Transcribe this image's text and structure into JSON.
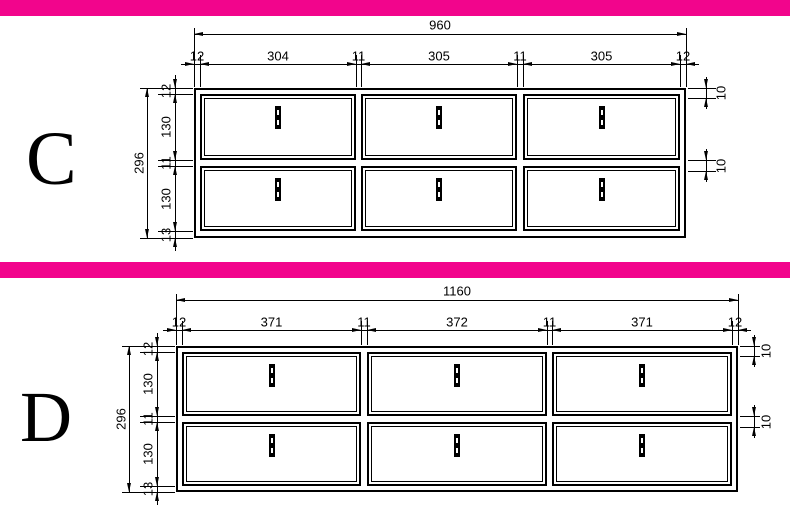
{
  "colors": {
    "separator_pink": "#F2058C",
    "line": "#000000",
    "background": "#FFFFFF"
  },
  "drawings": [
    {
      "label": "C",
      "width_total": "960",
      "width_segments": [
        "12",
        "304",
        "11",
        "305",
        "11",
        "305",
        "12"
      ],
      "height_total": "296",
      "height_segments": [
        "12",
        "130",
        "11",
        "130",
        "13"
      ],
      "side_offsets": [
        "10",
        "10"
      ]
    },
    {
      "label": "D",
      "width_total": "1160",
      "width_segments": [
        "12",
        "371",
        "11",
        "372",
        "11",
        "371",
        "12"
      ],
      "height_total": "296",
      "height_segments": [
        "12",
        "130",
        "11",
        "130",
        "13"
      ],
      "side_offsets": [
        "10",
        "10"
      ]
    }
  ]
}
